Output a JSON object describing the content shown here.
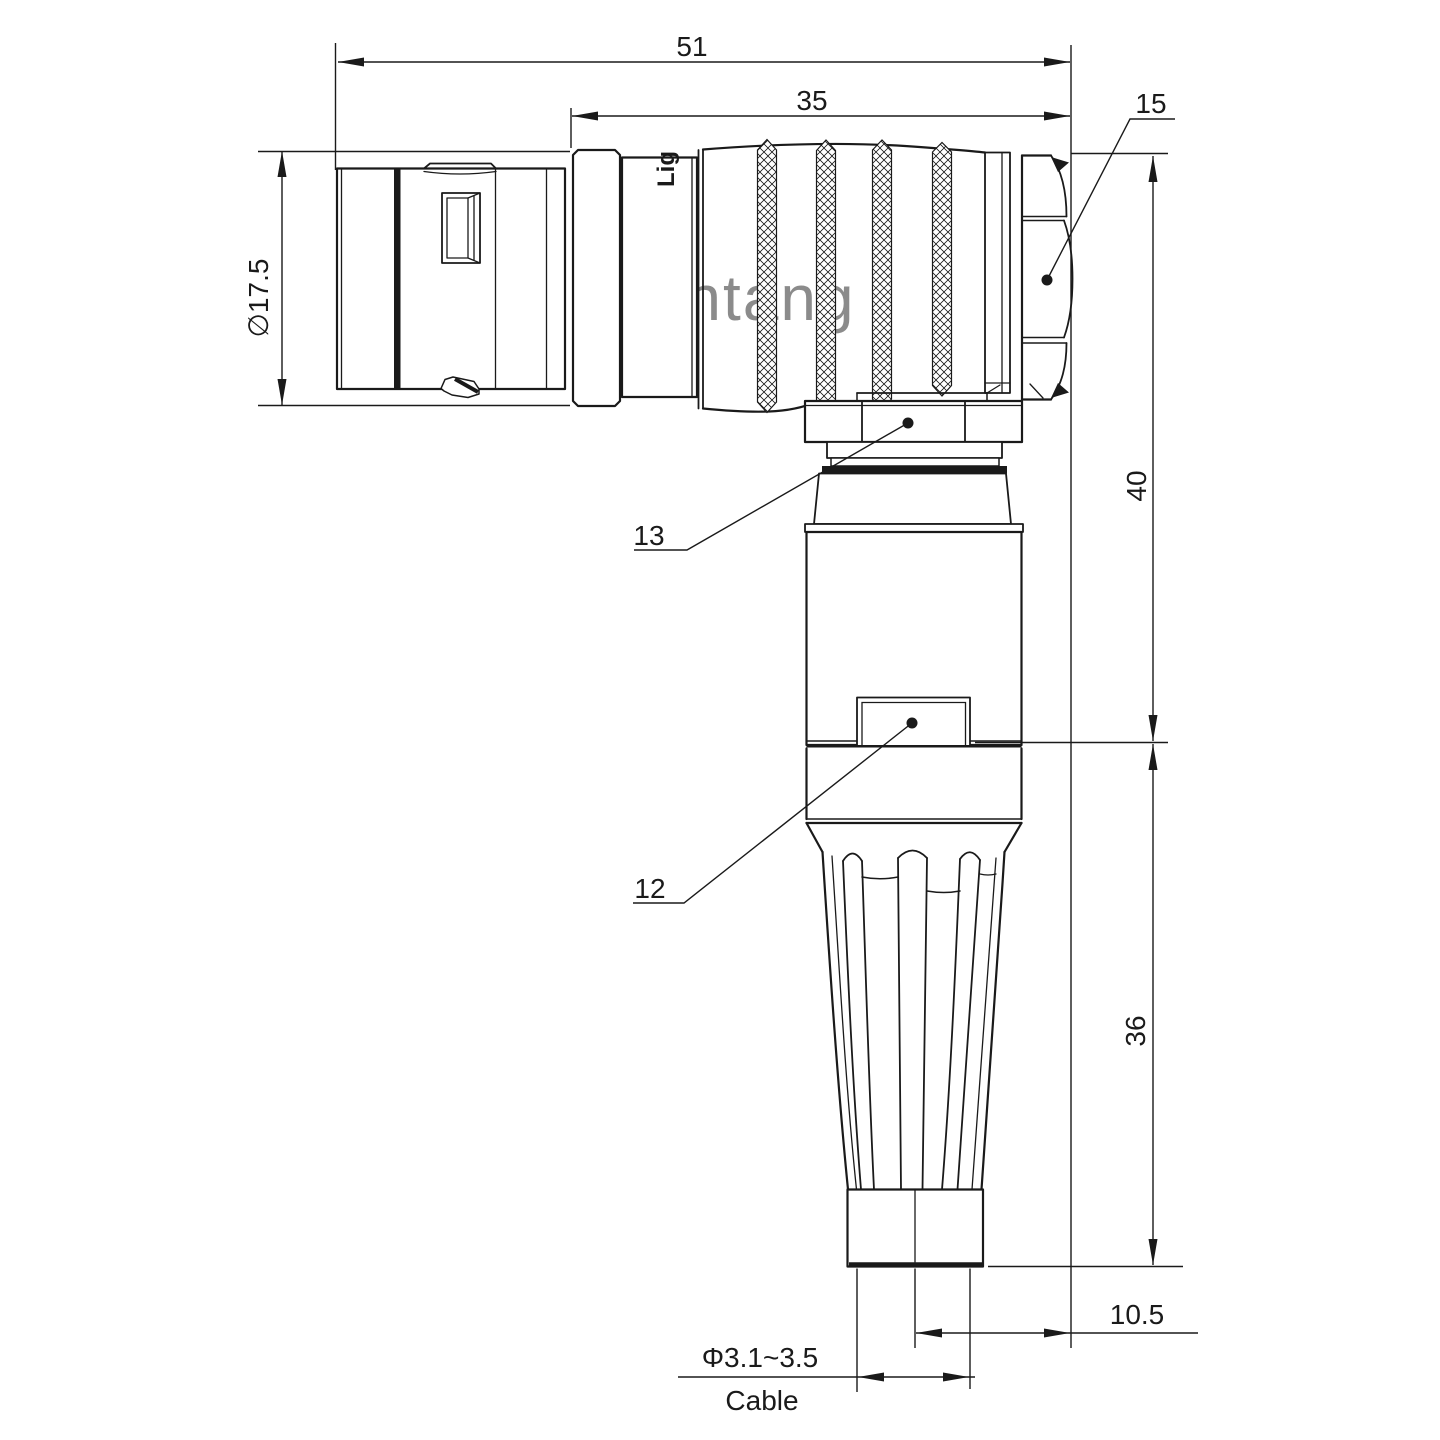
{
  "watermark": {
    "text": "Lightang",
    "color": "#E9A6A6"
  },
  "part_marking": "Lig",
  "dims": {
    "overall_length": "51",
    "front_length": "35",
    "diameter": "∅17.5",
    "height_upper": "40",
    "height_lower": "36",
    "offset": "10.5",
    "cable_diameter": "Φ3.1~3.5",
    "cable_label": "Cable"
  },
  "callouts": {
    "backshell_nut": "15",
    "coupling_nut": "13",
    "body": "12"
  },
  "colors": {
    "line": "#1a1a1a",
    "background": "#ffffff"
  }
}
